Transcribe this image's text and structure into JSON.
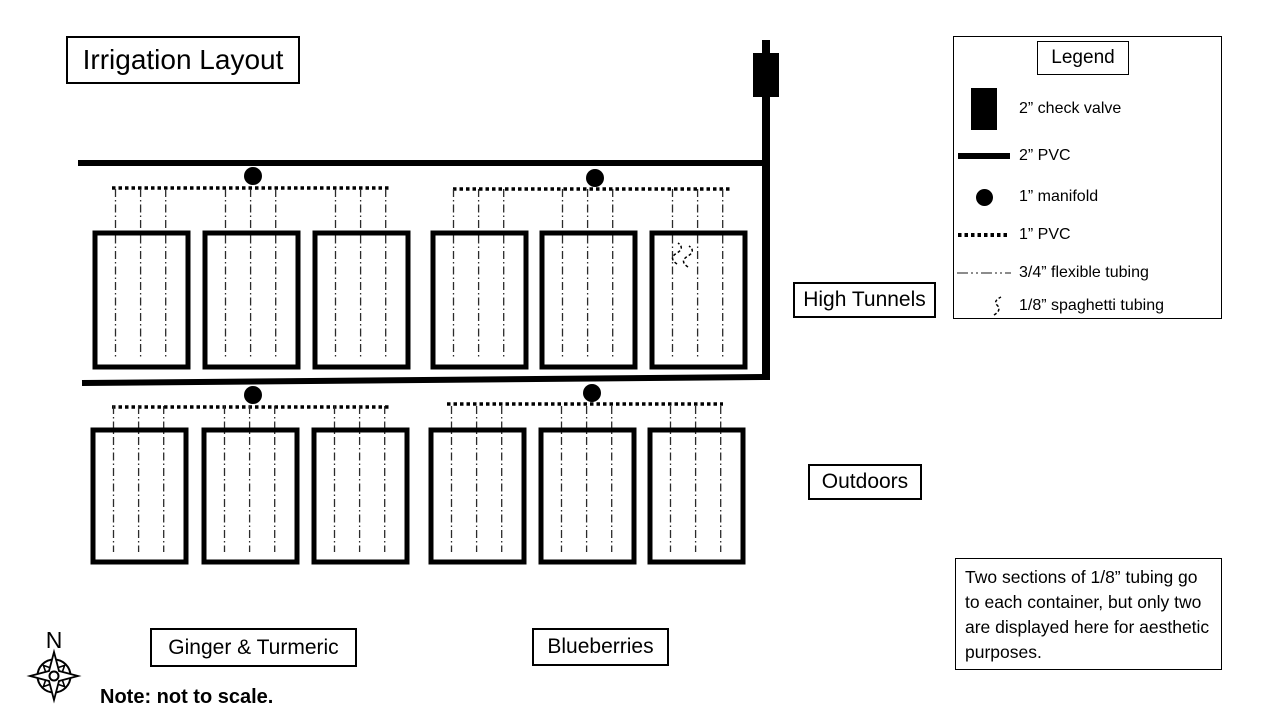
{
  "title": "Irrigation Layout",
  "legend": {
    "title": "Legend",
    "items": [
      {
        "name": "check-valve",
        "label": "2” check valve"
      },
      {
        "name": "pvc-2in",
        "label": "2” PVC"
      },
      {
        "name": "manifold-1in",
        "label": "1” manifold"
      },
      {
        "name": "pvc-1in",
        "label": "1” PVC"
      },
      {
        "name": "flexible-tubing-34in",
        "label": "3/4” flexible tubing"
      },
      {
        "name": "spaghetti-tubing-18in",
        "label": "1/8” spaghetti tubing"
      }
    ]
  },
  "area_labels": {
    "high_tunnels": "High Tunnels",
    "outdoors": "Outdoors",
    "ginger_turmeric": "Ginger & Turmeric",
    "blueberries": "Blueberries"
  },
  "note_box_text": "Two sections of 1/8” tubing go to each container, but only two are displayed here for aesthetic purposes.",
  "scale_note": "Note: not to scale.",
  "compass_north_label": "N",
  "colors": {
    "line": "#000000",
    "background": "#ffffff"
  }
}
